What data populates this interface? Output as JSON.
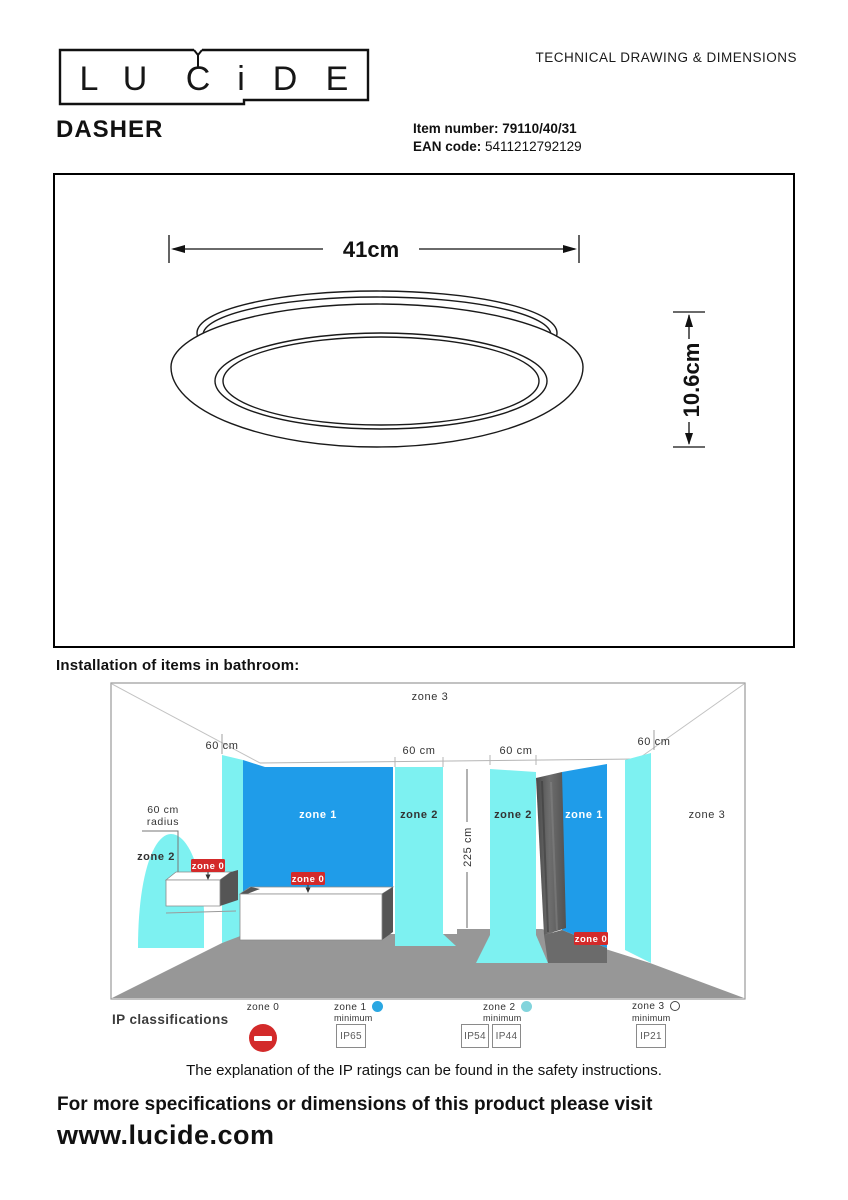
{
  "header": {
    "logo_letters": [
      "L",
      "U",
      "C",
      "i",
      "D",
      "E"
    ],
    "doc_title": "TECHNICAL DRAWING & DIMENSIONS"
  },
  "product": {
    "name": "DASHER",
    "item_number_label": "Item number:",
    "item_number_value": "79110/40/31",
    "ean_label": "EAN code:",
    "ean_value": "5411212792129"
  },
  "technical_drawing": {
    "width_dimension": "41cm",
    "height_dimension": "10.6cm"
  },
  "bathroom_section": {
    "heading": "Installation of items in bathroom:",
    "zone3_top": "zone 3",
    "dim_60_left": "60 cm",
    "dim_60_bath": "60 cm",
    "dim_60_shower": "60 cm",
    "dim_60_right": "60 cm",
    "dim_225": "225 cm",
    "radius_label_line1": "60 cm",
    "radius_label_line2": "radius",
    "zone2_basin": "zone 2",
    "zone0_basin": "zone 0",
    "zone1_bath": "zone 1",
    "zone2_bath": "zone 2",
    "zone0_bath": "zone 0",
    "zone2_shower": "zone 2",
    "zone1_shower": "zone 1",
    "zone0_shower": "zone 0",
    "zone3_right": "zone 3",
    "colors": {
      "zone1_fill": "#1f9ce9",
      "zone2_fill": "#7df1f1",
      "zone0_badge": "#d32a2a",
      "floor": "#979797",
      "shower_door": "#5a5a5a"
    }
  },
  "legend": {
    "title": "IP classifications",
    "zone0_label": "zone 0",
    "zone1_label": "zone 1",
    "zone2_label": "zone 2",
    "zone3_label": "zone 3",
    "minimum_label_1": "minimum",
    "minimum_label_2": "minimum",
    "minimum_label_3": "minimum",
    "ip_zone1": "IP65",
    "ip_zone2_a": "IP54",
    "ip_zone2_b": "IP44",
    "ip_zone3": "IP21",
    "marker_colors": {
      "zone1_dot": "#2aa7e2",
      "zone2_dot": "#82d4dc",
      "zone0_icon": "#d32a2a"
    }
  },
  "footer": {
    "ip_note": "The explanation of the IP ratings can be found in the safety instructions.",
    "visit_text": "For more specifications or dimensions of this product please visit",
    "website": "www.lucide.com"
  }
}
